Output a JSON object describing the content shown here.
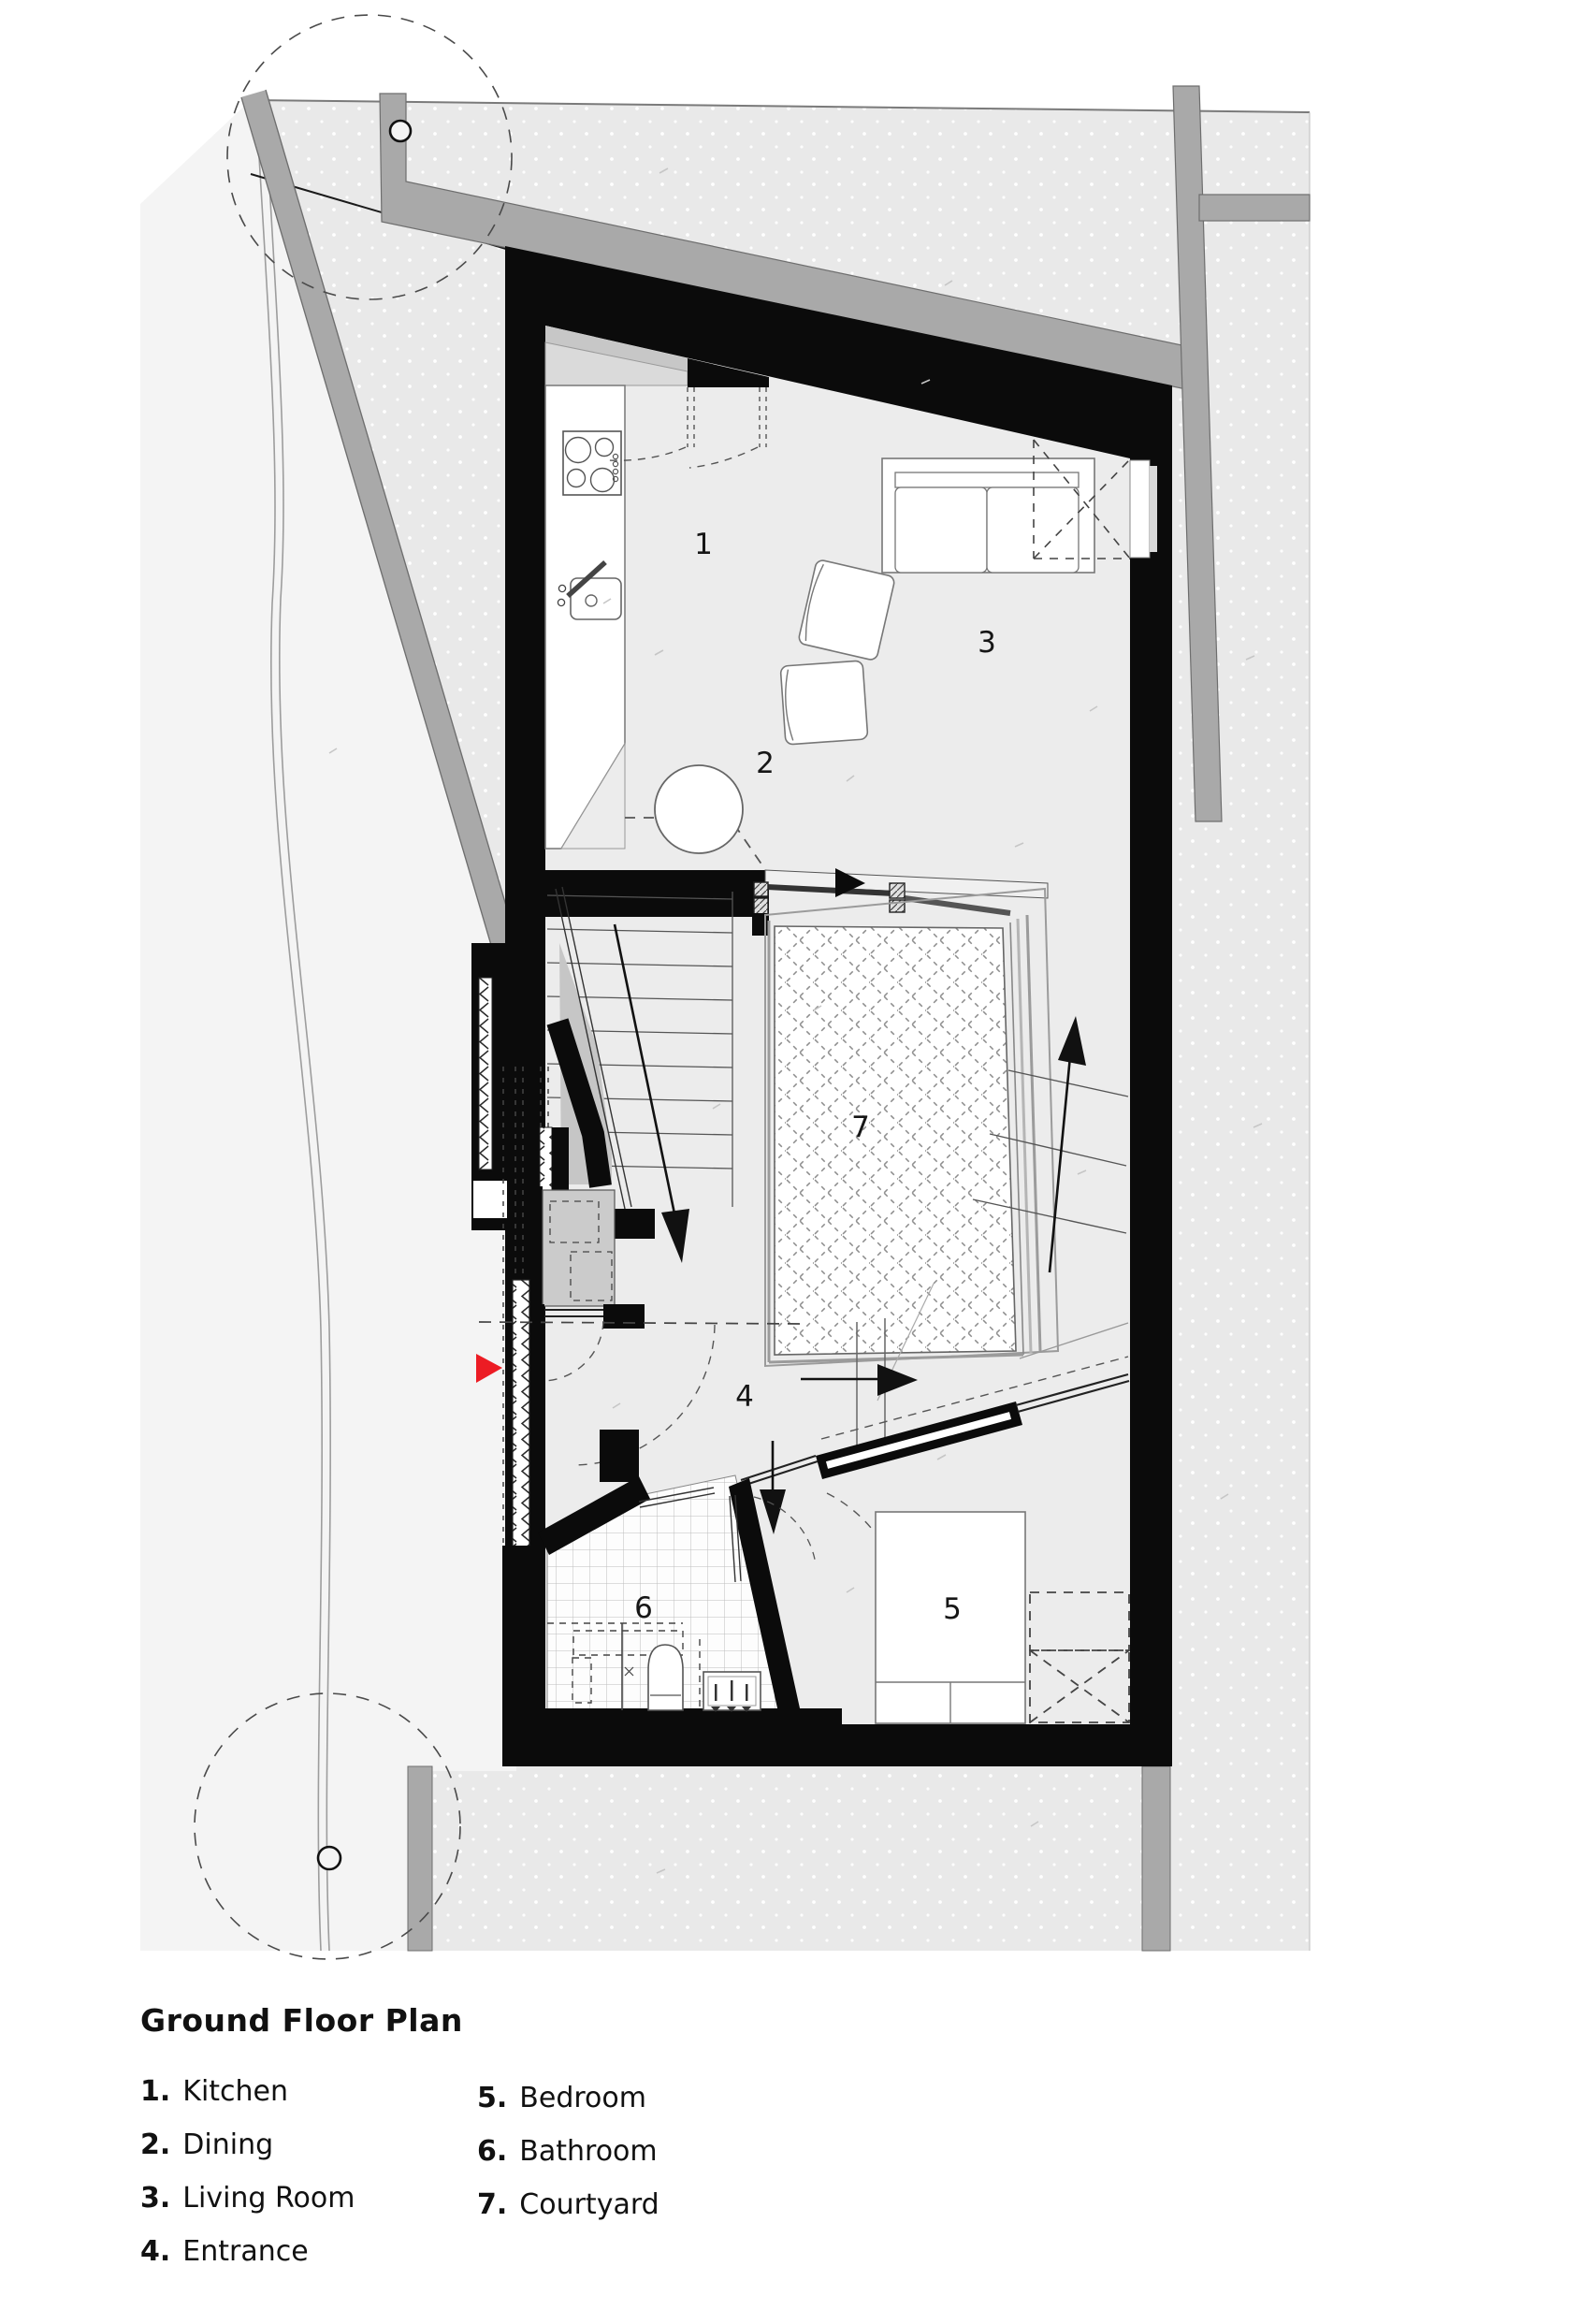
{
  "legend": {
    "title": "Ground Floor Plan",
    "columns": [
      {
        "items": [
          {
            "num": "1.",
            "label": "Kitchen"
          },
          {
            "num": "2.",
            "label": "Dining"
          },
          {
            "num": "3.",
            "label": "Living Room"
          },
          {
            "num": "4.",
            "label": "Entrance"
          }
        ]
      },
      {
        "items": [
          {
            "num": "5.",
            "label": "Bedroom"
          },
          {
            "num": "6.",
            "label": "Bathroom"
          },
          {
            "num": "7.",
            "label": "Courtyard"
          }
        ]
      }
    ]
  },
  "rooms": {
    "kitchen": "1",
    "dining": "2",
    "living_room": "3",
    "entrance": "4",
    "bedroom": "5",
    "bathroom": "6",
    "courtyard": "7"
  },
  "icons": {
    "entrance_marker": "red-right-arrow",
    "stairs_down": "long-down-arrow",
    "stairs_up": "long-up-arrow",
    "slide_direction": "right-arrow",
    "door_direction": "down-arrow"
  },
  "colors": {
    "accent_red": "#ec1c24",
    "wall_black": "#0b0b0b",
    "road_gray": "#a9a9a9",
    "site_gray": "#e9e9e9",
    "floor_gray": "#ececec"
  }
}
